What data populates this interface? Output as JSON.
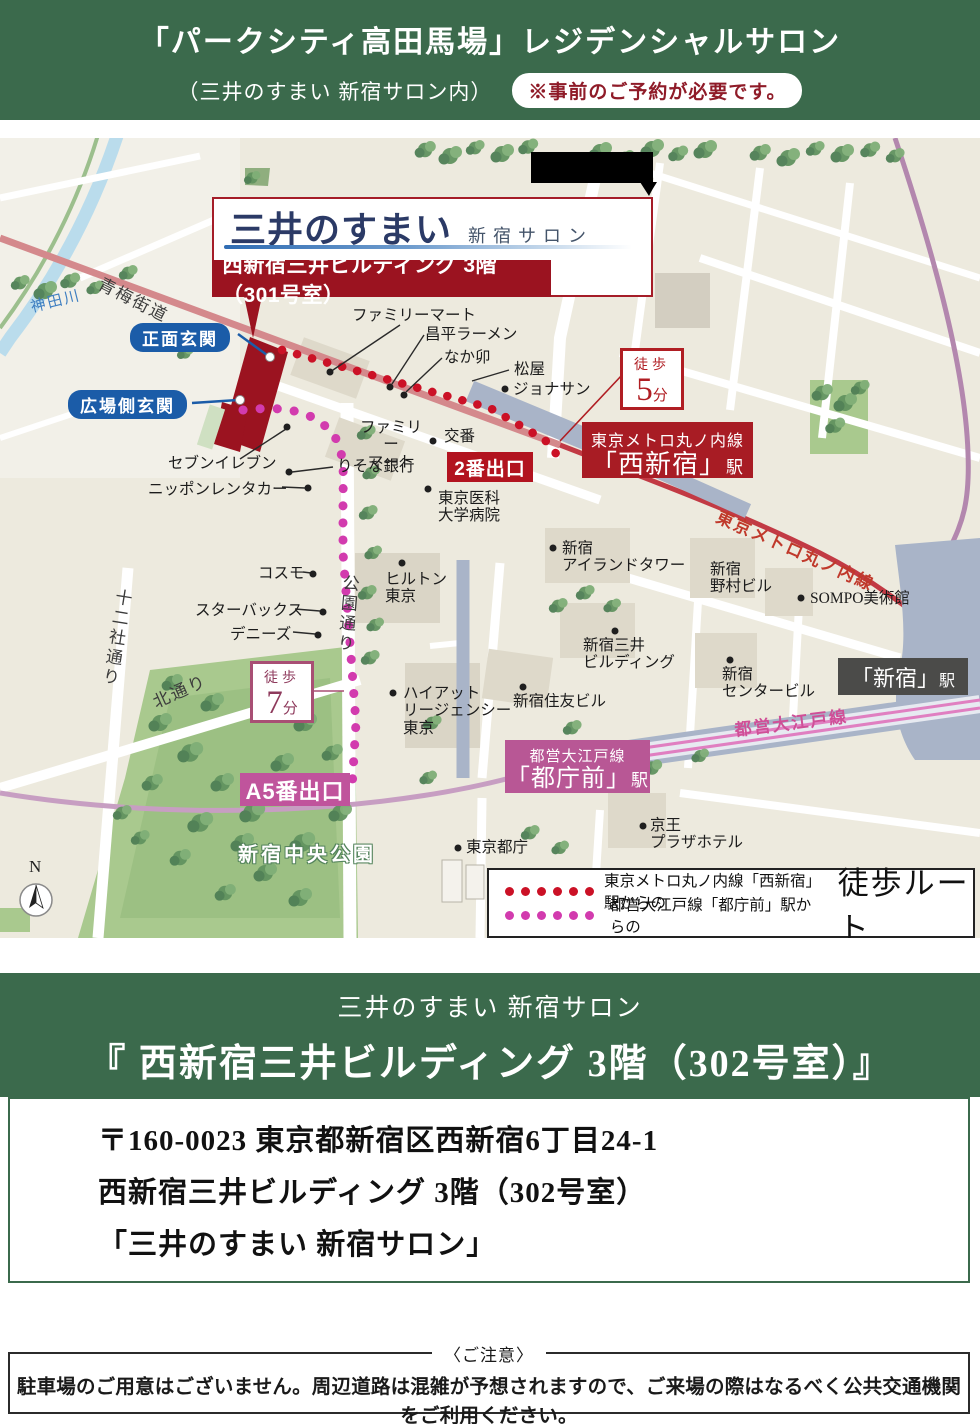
{
  "header": {
    "title": "「パークシティ高田馬場」レジデンシャルサロン",
    "subtitle": "（三井のすまい 新宿サロン内）",
    "reservation_note": "※事前のご予約が必要です。"
  },
  "map": {
    "callout": {
      "logo": "三井のすまい",
      "logo_suffix": "新宿サロン",
      "building_banner": "西新宿三井ビルディング 3階（301号室）"
    },
    "entrances": {
      "front": "正面玄関",
      "plaza": "広場側玄関"
    },
    "exits": {
      "exit2": "2番出口",
      "exitA5": "A5番出口"
    },
    "walk5": {
      "label": "徒歩",
      "num": "5",
      "unit": "分"
    },
    "walk7": {
      "label": "徒歩",
      "num": "7",
      "unit": "分"
    },
    "st_nishishinjuku": {
      "line": "東京メトロ丸ノ内線",
      "name": "「西新宿」",
      "suffix": "駅"
    },
    "st_tochomae": {
      "line": "都営大江戸線",
      "name": "「都庁前」",
      "suffix": "駅"
    },
    "st_shinjuku": {
      "name": "「新宿」",
      "suffix": "駅"
    },
    "rail_marunouchi": "東京メトロ丸ノ内線",
    "rail_oedo": "都営大江戸線",
    "roads": {
      "ome_kaido": "青梅街道",
      "kanda_river": "神田川",
      "junisha_dori": "十二社通り",
      "kita_dori": "北通り",
      "koen_dori": "公園通り"
    },
    "park": "新宿中央公園",
    "compass_n": "N",
    "places": {
      "fm1": "ファミリーマート",
      "shohei": "昌平ラーメン",
      "nakau": "なか卯",
      "matsuya": "松屋",
      "jonathan": "ジョナサン",
      "koban": "交番",
      "fm2": "ファミリー\nマート",
      "risona": "りそな銀行",
      "seven": "セブンイレブン",
      "rentacar": "ニッポンレンタカー",
      "tokyomed": "東京医科\n大学病院",
      "island": "新宿\nアイランドタワー",
      "cosmo": "コスモ",
      "starbucks": "スターバックス",
      "dennys": "デニーズ",
      "hilton": "ヒルトン\n東京",
      "hyatt": "ハイアット\nリージェンシー\n東京",
      "sumitomo": "新宿住友ビル",
      "mitsui_bldg": "新宿三井\nビルディング",
      "nomura": "新宿\n野村ビル",
      "sompo": "SOMPO美術館",
      "center_bldg": "新宿\nセンタービル",
      "keio": "京王\nプラザホテル",
      "tocho": "東京都庁"
    },
    "legend": {
      "red_route": "東京メトロ丸ノ内線「西新宿」駅からの",
      "pink_route": "都営大江戸線「都庁前」駅からの",
      "title": "徒歩ルート"
    }
  },
  "salon": {
    "line1": "三井のすまい 新宿サロン",
    "line2": "『 西新宿三井ビルディング 3階（302号室）』"
  },
  "address": {
    "line1": "〒160-0023 東京都新宿区西新宿6丁目24-1",
    "line2": "西新宿三井ビルディング 3階（302号室）",
    "line3": "「三井のすまい 新宿サロン」"
  },
  "notice": {
    "title": "〈ご注意〉",
    "body": "駐車場のご用意はございません。周辺道路は混雑が予想されますので、ご来場の際はなるべく公共交通機関をご利用ください。"
  },
  "colors": {
    "header_green": "#3b6a4c",
    "crimson_banner": "#a81c24",
    "building_red": "#9b1320",
    "route_red": "#cb1126",
    "route_pink": "#d23bae",
    "tochomae_pink": "#b85795",
    "entrance_blue": "#1b5ca8",
    "station_gray": "#4b4b49"
  }
}
